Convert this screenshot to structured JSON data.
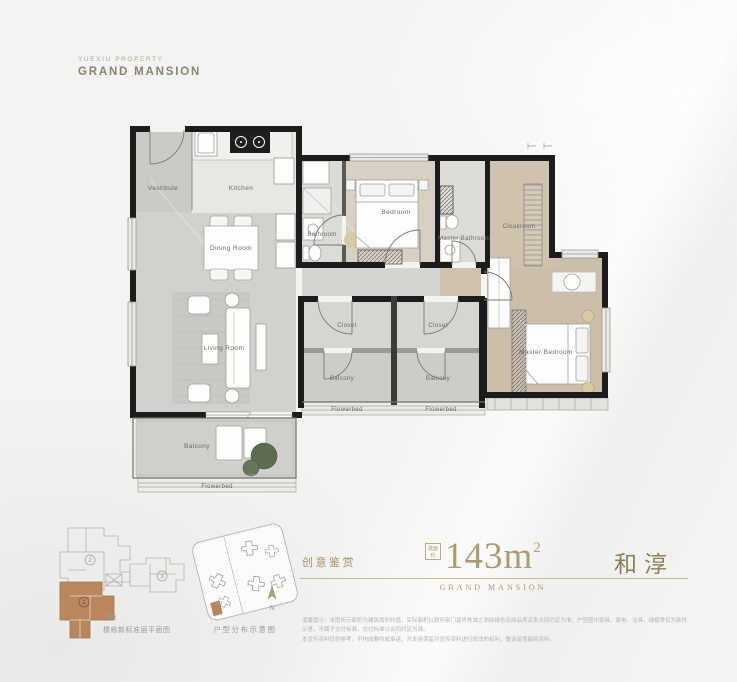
{
  "brand": {
    "company": "YUEXIU PROPERTY",
    "name": "GRAND MANSION"
  },
  "floorplan": {
    "rooms": {
      "vestibule": "Vestibule",
      "kitchen": "Kitchen",
      "dining_room": "Dining Room",
      "living_room": "Living Room",
      "bathroom": "Bathroom",
      "bedroom": "Bedroom",
      "master_bathroom": "Master Bathroom",
      "cloakroom": "Cloakroom",
      "master_bedroom": "Master Bedroom",
      "closet_left": "Closet",
      "closet_right": "Closet",
      "balcony_left": "Balcony",
      "balcony_right": "Balcony",
      "balcony_main": "Balcony",
      "flowerbed_left": "Flowerbed",
      "flowerbed_right": "Flowerbed",
      "flowerbed_main": "Flowerbed"
    }
  },
  "keyplan": {
    "building": "3栋",
    "caption": "楼栋新标准层平面图",
    "units": [
      "1",
      "2",
      "3"
    ],
    "highlight_color": "#b9865e"
  },
  "siteplan": {
    "caption": "户型分布示意图",
    "north": "N"
  },
  "info": {
    "creative": "创意鉴赏",
    "area_tag_line1": "建面",
    "area_tag_line2": "约",
    "area_value": "143m",
    "area_sup": "2",
    "unit_name": "和淳",
    "brand_en": "GRAND MANSION",
    "disclaimer_line1": "温馨提示：本图所示面积为建筑面积约值，实际面积以政府部门最终核准之测绘报告及商品房买卖合同约定为准；户型图中家具、家电、洁具、绿植等仅为装饰示意，不属于交付标准，交付标准以合同约定为准。",
    "disclaimer_line2": "本宣传资料仅供参考，不构成要约或承诺，开发商保留对宣传资料进行修改的权利，敬请留意最新资料。"
  },
  "colors": {
    "gold_accent": "#a89972",
    "area_gold": "#ab9c73",
    "unit_gold": "#8d8057",
    "highlight_brown": "#b9865e",
    "wall": "#1c1c1c"
  }
}
